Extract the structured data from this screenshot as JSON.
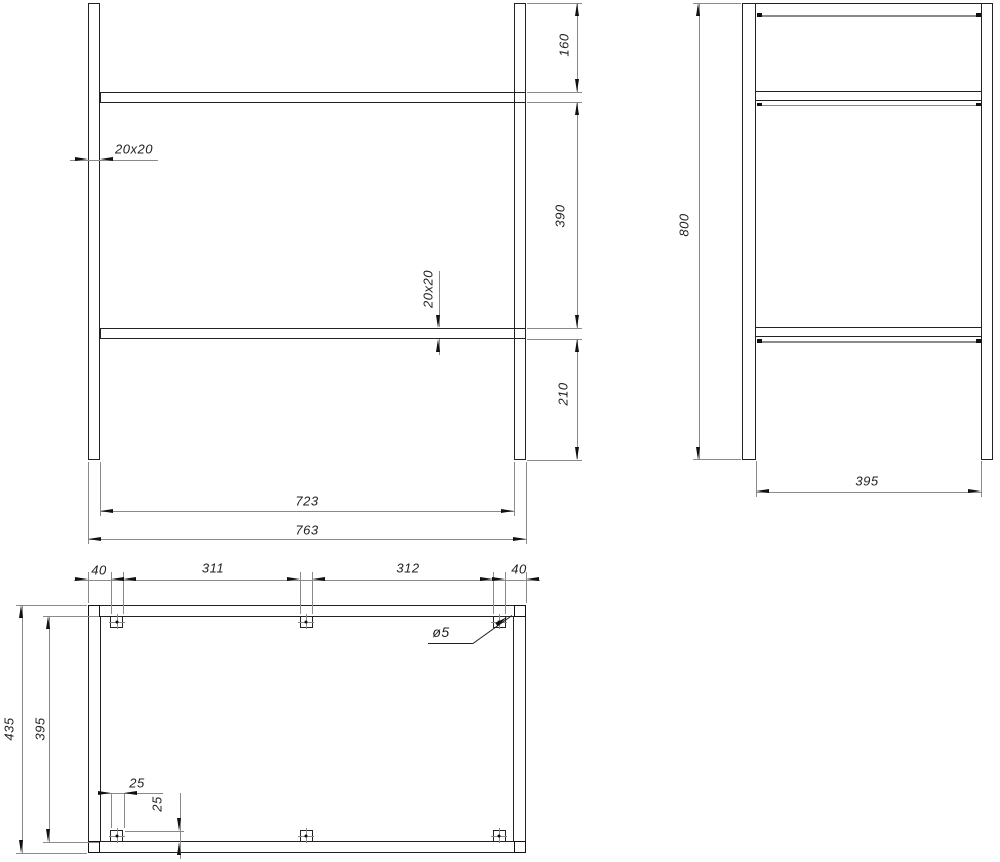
{
  "drawing": {
    "front_view": {
      "dim_160": "160",
      "dim_390": "390",
      "dim_210": "210",
      "dim_723": "723",
      "dim_763": "763",
      "tube_size_h": "20x20",
      "tube_size_v": "20x20"
    },
    "side_view": {
      "dim_800": "800",
      "dim_395": "395"
    },
    "plan_view": {
      "dim_40_left": "40",
      "dim_311": "311",
      "dim_312": "312",
      "dim_40_right": "40",
      "dim_435": "435",
      "dim_395": "395",
      "dim_25_h": "25",
      "dim_25_v": "25",
      "hole_dia": "ø5"
    }
  },
  "colors": {
    "object_line": "#222222",
    "dimension_line": "#8a8a8a",
    "arrow": "#111111",
    "text": "#222222",
    "background": "#ffffff"
  }
}
